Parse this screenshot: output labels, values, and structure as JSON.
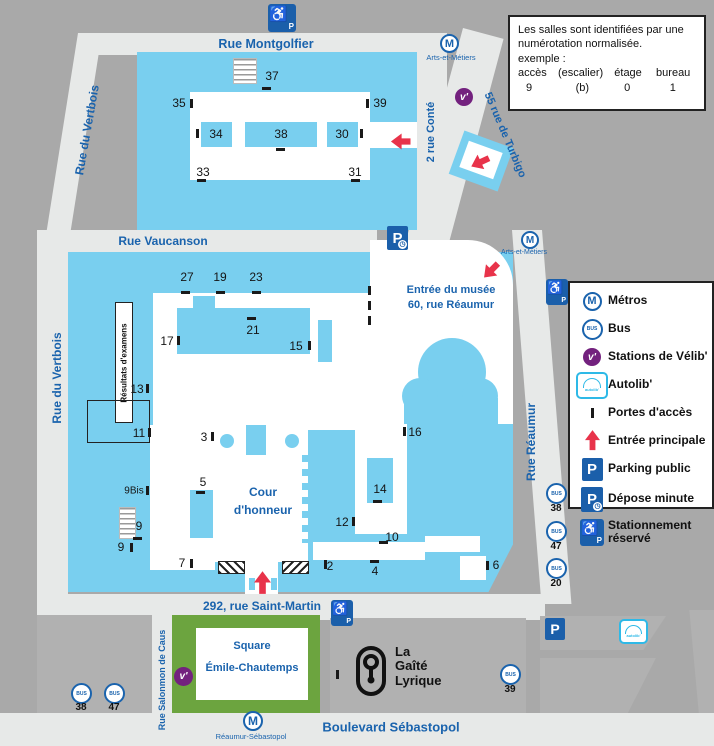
{
  "info_box": {
    "line1": "Les salles sont identifiées par une",
    "line2": "numérotation normalisée.",
    "line3": "exemple :",
    "columns": [
      "accès",
      "(escalier)",
      "étage",
      "bureau"
    ],
    "values": [
      "9",
      "(b)",
      "0",
      "1"
    ]
  },
  "legend": {
    "items": [
      {
        "label": "Métros"
      },
      {
        "label": "Bus"
      },
      {
        "label": "Stations de Vélib'"
      },
      {
        "label": "Autolib'"
      },
      {
        "label": "Portes  d'accès"
      },
      {
        "label": "Entrée  principale"
      },
      {
        "label": "Parking public"
      },
      {
        "label": "Dépose minute"
      },
      {
        "label": "Stationnement réservé"
      }
    ]
  },
  "streets": {
    "montgolfier": "Rue Montgolfier",
    "vertbois_top": "Rue du Vertbois",
    "conte": "2 rue Conté",
    "turbigo": "55 rue de Turbigo",
    "vaucanson": "Rue Vaucanson",
    "vertbois_left": "Rue du Vertbois",
    "reaumur": "Rue Réaumur",
    "saint_martin": "292, rue Saint-Martin",
    "salomon": "Rue Salonmon de Caus",
    "sebastopol": "Boulevard Sébastopol"
  },
  "metro_stations": {
    "arts_top": "Arts-et-Métiers",
    "arts_right": "Arts-et-Métiers",
    "reaumur_sebastopol": "Réaumur-Sébastopol"
  },
  "areas": {
    "musee_line1": "Entrée du musée",
    "musee_line2": "60, rue Réaumur",
    "cour_line1": "Cour",
    "cour_line2": "d'honneur",
    "resultats": "Résultats d'examens",
    "square_line1": "Square",
    "square_line2": "Émile-Chautemps",
    "gaite_line1": "La",
    "gaite_line2": "Gaîté",
    "gaite_line3": "Lyrique"
  },
  "numbers_top": [
    "37",
    "35",
    "39",
    "34",
    "38",
    "30",
    "33",
    "31"
  ],
  "numbers_main": [
    "27",
    "19",
    "23",
    "17",
    "21",
    "15",
    "13",
    "11",
    "3",
    "16",
    "9Bis",
    "5",
    "9",
    "9",
    "7",
    "14",
    "12",
    "10",
    "2",
    "4",
    "6"
  ],
  "bus_stops": {
    "reaumur_column": [
      "38",
      "47",
      "20"
    ],
    "bottom_left": [
      "38",
      "47"
    ],
    "gaite": "39"
  },
  "icons": {
    "metro_letter": "M",
    "bus_text": "BUS",
    "velib_text": "v'",
    "autolib_text": "autolib'",
    "parking_letter": "P",
    "wheelchair": "♿",
    "clock": "◷"
  }
}
